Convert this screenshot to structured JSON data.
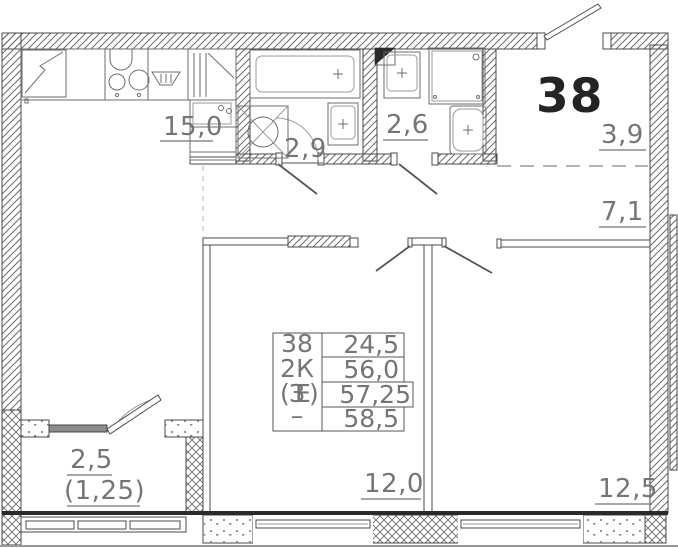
{
  "apartment": {
    "number": "38"
  },
  "rooms": {
    "kitchen_living": {
      "area": "15,0"
    },
    "bathroom": {
      "area": "2,9"
    },
    "wc": {
      "area": "2,6"
    },
    "entry_hall": {
      "area": "3,9"
    },
    "hallway": {
      "area": "7,1"
    },
    "bedroom_1": {
      "area": "12,0"
    },
    "bedroom_2": {
      "area": "12,5"
    },
    "balcony": {
      "area": "2,5",
      "area_with_coefficient": "(1,25)"
    }
  },
  "stamp": {
    "left_column": [
      "38",
      "2К",
      [
        "(",
        "З",
        "Е",
        ")"
      ],
      "–"
    ],
    "values": [
      "24,5",
      "56,0",
      "57,25",
      "58,5"
    ]
  },
  "colors": {
    "wall_line": "#4a4a4a",
    "fixture_line": "#6e6e6e",
    "label_text": "#757575",
    "apartment_number_text": "#242424",
    "thick_wall_line": "#2a2a2a"
  }
}
